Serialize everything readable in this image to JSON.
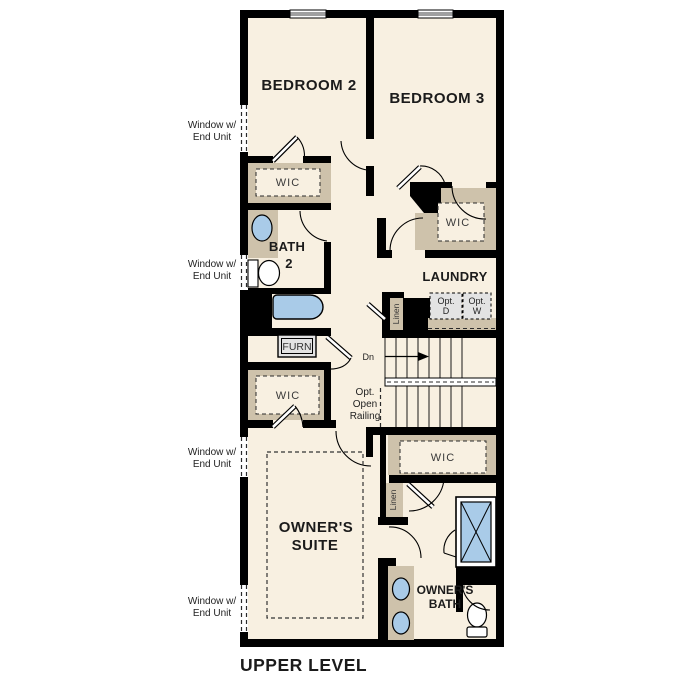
{
  "title": "UPPER LEVEL",
  "labels": {
    "bedroom2": "BEDROOM 2",
    "bedroom3": "BEDROOM 3",
    "wic": "WIC",
    "bath2": {
      "l1": "BATH",
      "l2": "2"
    },
    "laundry": "LAUNDRY",
    "opt_d": {
      "l1": "Opt.",
      "l2": "D"
    },
    "opt_w": {
      "l1": "Opt.",
      "l2": "W"
    },
    "linen": "Linen",
    "furn": "FURN",
    "dn": "Dn",
    "railing": {
      "l1": "Opt.",
      "l2": "Open",
      "l3": "Railing"
    },
    "owners_suite": {
      "l1": "OWNER'S",
      "l2": "SUITE"
    },
    "owners_bath": {
      "l1": "OWNER'S",
      "l2": "BATH"
    },
    "window_note": {
      "l1": "Window w/",
      "l2": "End Unit"
    }
  },
  "colors": {
    "floor": "#f8f0e1",
    "wall": "#000000",
    "closet_tan": "#cec2ab",
    "fixture_blue": "#a9cbe8",
    "appliance_gray": "#e3e3e3",
    "background": "#ffffff"
  }
}
